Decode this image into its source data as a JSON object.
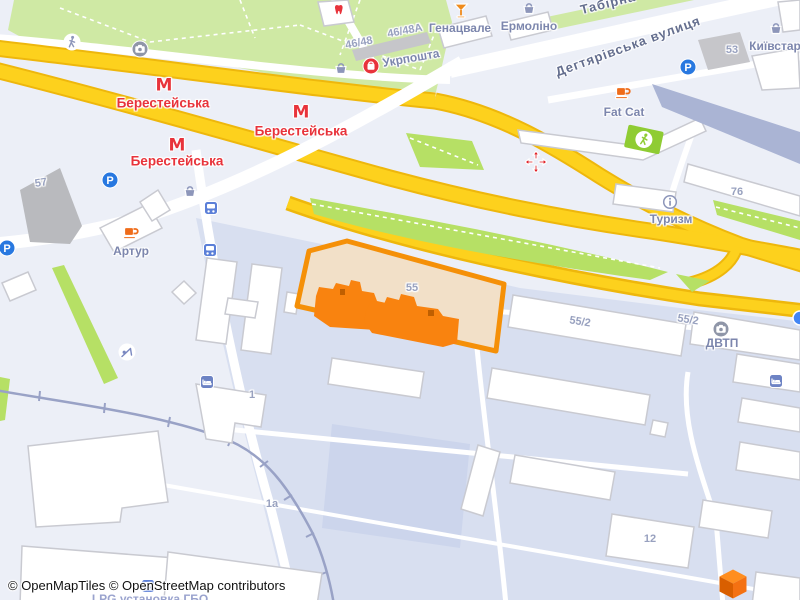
{
  "attribution": "© OpenMapTiles © OpenStreetMap contributors",
  "colors": {
    "background": "#eceff7",
    "industrial_zone": "#d8dff0",
    "park_green": "#cfe9a4",
    "median_green": "#b6e065",
    "highway_yellow": "#fdd11d",
    "highway_casing": "#eeb70c",
    "road_white": "#ffffff",
    "building_white": "#ffffff",
    "building_dark": "#aab4d4",
    "building_grey": "#b9babe",
    "selection_fill": "#f2e0c8",
    "selection_stroke": "#f59008",
    "selected_building": "#f9830f",
    "metro_red": "#e8333b",
    "poi_blue": "#7c86ad",
    "parking_blue": "#2878e0",
    "transit_blue": "#5b7fd8",
    "railway": "#99a2c6",
    "logo_orange": "#f47112"
  },
  "map": {
    "selected_parcel": {
      "number": "55"
    },
    "labels": [
      {
        "name": "label-genatsvale",
        "text": "Генацвале",
        "x": 460,
        "y": 28,
        "rot": 0,
        "cls": "poi"
      },
      {
        "name": "label-ermolino",
        "text": "Ермоліно",
        "x": 529,
        "y": 26,
        "rot": 0,
        "cls": "poi"
      },
      {
        "name": "label-ukrposhta",
        "text": "Укрпошта",
        "x": 411,
        "y": 58,
        "rot": -10,
        "cls": "poi"
      },
      {
        "name": "label-fat-cat",
        "text": "Fat Cat",
        "x": 624,
        "y": 112,
        "rot": 0,
        "cls": "poi"
      },
      {
        "name": "label-turyzm",
        "text": "Туризм",
        "x": 671,
        "y": 219,
        "rot": 0,
        "cls": "poi"
      },
      {
        "name": "label-artur",
        "text": "Артур",
        "x": 131,
        "y": 251,
        "rot": 0,
        "cls": "poi"
      },
      {
        "name": "label-kyivstar",
        "text": "Київстар",
        "x": 775,
        "y": 46,
        "rot": 0,
        "cls": "poi"
      },
      {
        "name": "label-dvtp",
        "text": "ДВТП",
        "x": 722,
        "y": 343,
        "rot": 0,
        "cls": "poi"
      },
      {
        "name": "label-house-46-48a",
        "text": "46/48А",
        "x": 405,
        "y": 31,
        "rot": -11,
        "cls": "num"
      },
      {
        "name": "label-house-46-48",
        "text": "46/48",
        "x": 359,
        "y": 43,
        "rot": -11,
        "cls": "num"
      },
      {
        "name": "label-house-53",
        "text": "53",
        "x": 732,
        "y": 50,
        "rot": 0,
        "cls": "num"
      },
      {
        "name": "label-house-76",
        "text": "76",
        "x": 737,
        "y": 192,
        "rot": 0,
        "cls": "num"
      },
      {
        "name": "label-house-57",
        "text": "57",
        "x": 41,
        "y": 183,
        "rot": -10,
        "cls": "num"
      },
      {
        "name": "label-house-55",
        "text": "55",
        "x": 412,
        "y": 288,
        "rot": 0,
        "cls": "num"
      },
      {
        "name": "label-house-55-2-a",
        "text": "55/2",
        "x": 580,
        "y": 322,
        "rot": 9,
        "cls": "num"
      },
      {
        "name": "label-house-55-2-b",
        "text": "55/2",
        "x": 688,
        "y": 320,
        "rot": 9,
        "cls": "num"
      },
      {
        "name": "label-house-1",
        "text": "1",
        "x": 252,
        "y": 395,
        "rot": 0,
        "cls": "num"
      },
      {
        "name": "label-house-1a",
        "text": "1а",
        "x": 272,
        "y": 504,
        "rot": 0,
        "cls": "num"
      },
      {
        "name": "label-house-12",
        "text": "12",
        "x": 650,
        "y": 539,
        "rot": 0,
        "cls": "num"
      },
      {
        "name": "label-street-dehtiarivska",
        "text": "Дегтярівська вулиця",
        "x": 628,
        "y": 46,
        "rot": -20,
        "cls": "street"
      },
      {
        "name": "label-street-tabirna",
        "text": "Табірна",
        "x": 608,
        "y": 3,
        "rot": -14,
        "cls": "street"
      },
      {
        "name": "label-metro-berestejska-1",
        "text": "Берестейська",
        "x": 163,
        "y": 103,
        "rot": 0,
        "cls": "metro"
      },
      {
        "name": "label-metro-berestejska-2",
        "text": "Берестейська",
        "x": 301,
        "y": 131,
        "rot": 0,
        "cls": "metro"
      },
      {
        "name": "label-metro-berestejska-3",
        "text": "Берестейська",
        "x": 177,
        "y": 161,
        "rot": 0,
        "cls": "metro"
      },
      {
        "name": "label-lpg-installation",
        "text": "LPG установка ГБО",
        "x": 150,
        "y": 599,
        "rot": 0,
        "cls": "partial"
      }
    ],
    "icons": [
      {
        "name": "metro-icon-1",
        "kind": "metro",
        "x": 164,
        "y": 86
      },
      {
        "name": "metro-icon-2",
        "kind": "metro",
        "x": 301,
        "y": 113
      },
      {
        "name": "metro-icon-3",
        "kind": "metro",
        "x": 177,
        "y": 146
      },
      {
        "name": "parking-icon-1",
        "kind": "parking",
        "x": 110,
        "y": 180
      },
      {
        "name": "parking-icon-2",
        "kind": "parking",
        "x": 7,
        "y": 248
      },
      {
        "name": "parking-icon-3",
        "kind": "parking",
        "x": 688,
        "y": 67
      },
      {
        "name": "bus-stop-icon-1",
        "kind": "bus",
        "x": 211,
        "y": 208
      },
      {
        "name": "bus-stop-icon-2",
        "kind": "bus",
        "x": 210,
        "y": 250
      },
      {
        "name": "bus-stop-icon-3",
        "kind": "bus",
        "x": 148,
        "y": 586
      },
      {
        "name": "shop-basket-icon-1",
        "kind": "basket",
        "x": 529,
        "y": 8
      },
      {
        "name": "shop-basket-icon-2",
        "kind": "basket",
        "x": 341,
        "y": 68
      },
      {
        "name": "shop-basket-icon-3",
        "kind": "basket",
        "x": 190,
        "y": 191
      },
      {
        "name": "shop-basket-icon-4",
        "kind": "basket",
        "x": 776,
        "y": 28
      },
      {
        "name": "cafe-icon-artur",
        "kind": "coffee",
        "x": 131,
        "y": 233
      },
      {
        "name": "cafe-icon-fat-cat",
        "kind": "coffee",
        "x": 623,
        "y": 93
      },
      {
        "name": "bar-cocktail-icon",
        "kind": "cocktail",
        "x": 461,
        "y": 11
      },
      {
        "name": "dentist-tooth-icon",
        "kind": "tooth",
        "x": 340,
        "y": 10
      },
      {
        "name": "post-office-icon",
        "kind": "postshop",
        "x": 371,
        "y": 66
      },
      {
        "name": "info-icon",
        "kind": "info",
        "x": 670,
        "y": 202
      },
      {
        "name": "photo-camera-icon-1",
        "kind": "camera",
        "x": 140,
        "y": 49
      },
      {
        "name": "photo-camera-icon-2",
        "kind": "camera",
        "x": 721,
        "y": 329
      },
      {
        "name": "pedestrian-icon",
        "kind": "walk",
        "x": 72,
        "y": 42
      },
      {
        "name": "crossing-sign-icon",
        "kind": "crosssign",
        "x": 644,
        "y": 139
      },
      {
        "name": "crossing-arrows-icon",
        "kind": "crossarrows",
        "x": 536,
        "y": 162
      },
      {
        "name": "hotel-bed-icon-1",
        "kind": "bed",
        "x": 207,
        "y": 382
      },
      {
        "name": "hotel-bed-icon-2",
        "kind": "bed",
        "x": 776,
        "y": 381
      },
      {
        "name": "playground-icon",
        "kind": "playground",
        "x": 127,
        "y": 352
      },
      {
        "name": "poi-dot-icon",
        "kind": "bluedot",
        "x": 800,
        "y": 318
      },
      {
        "name": "openmaptiles-cube-logo",
        "kind": "cube",
        "x": 733,
        "y": 584
      }
    ]
  }
}
